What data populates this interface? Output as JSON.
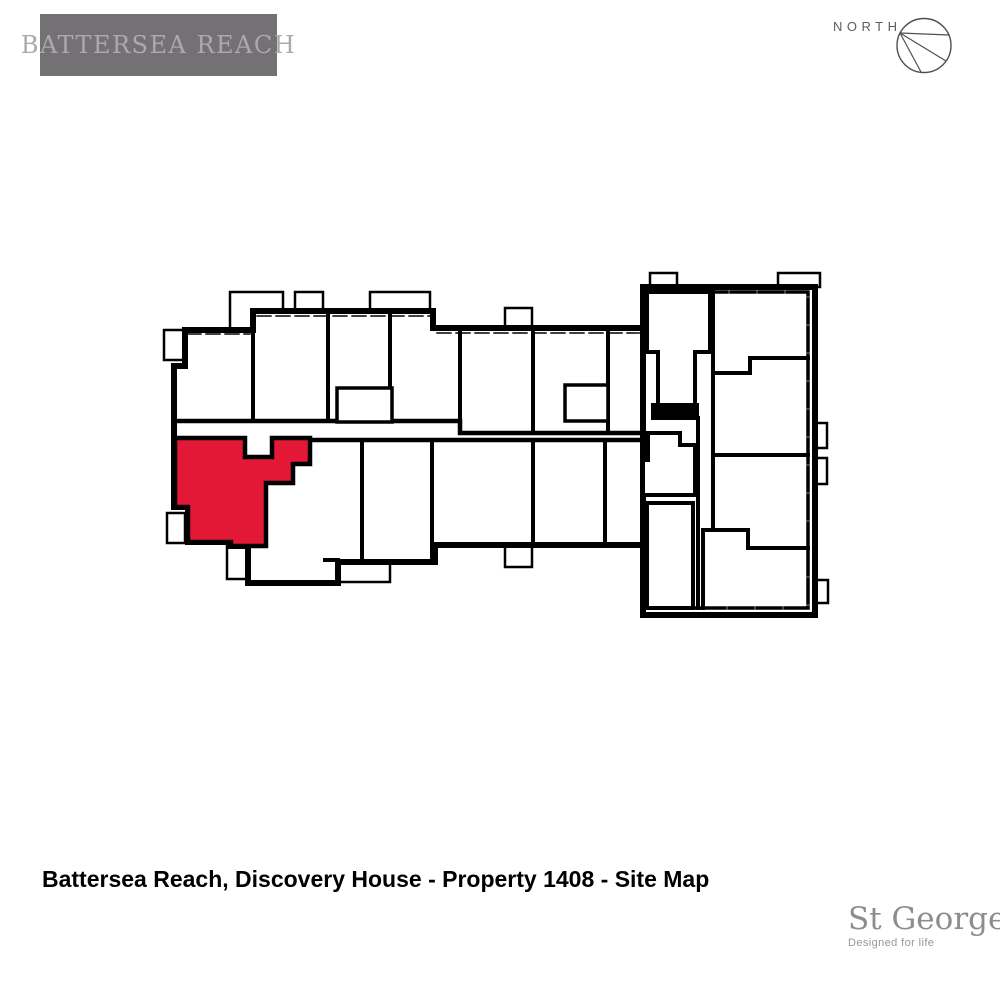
{
  "header": {
    "logo": {
      "text": "BATTERSEA REACH",
      "bg_color": "#747174",
      "text_color": "#ABA9AC"
    },
    "compass": {
      "label": "NORTH"
    }
  },
  "plan": {
    "development": "Battersea Reach",
    "building": "Discovery House",
    "highlighted_property": "1408",
    "highlight_color": "#E31837",
    "wall_color": "#000000"
  },
  "footer": {
    "caption": "Battersea Reach, Discovery House - Property 1408 - Site Map",
    "developer": {
      "name": "St George",
      "tagline": "Designed for life"
    }
  }
}
